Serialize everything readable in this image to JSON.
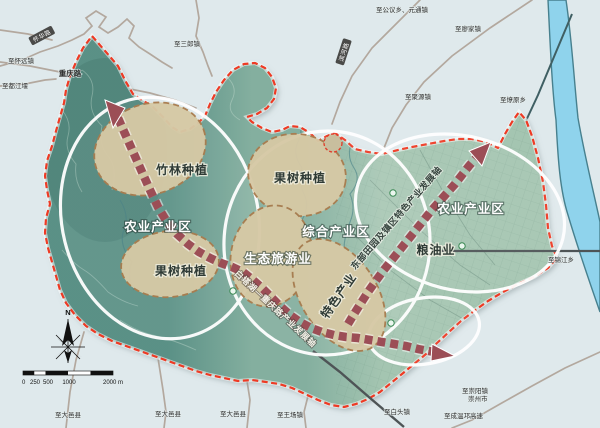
{
  "map": {
    "zones": [
      "农业产业区",
      "综合产业区",
      "农业产业区",
      "生态旅游业"
    ],
    "plots": [
      "竹林种植",
      "果树种植",
      "果树种植",
      "粮油业",
      "特色产业"
    ],
    "axes": [
      "白塔湖—重庆路产业发展轴",
      "东部田园及镇区特色产业发展轴"
    ],
    "roads": {
      "chongqing": "重庆路",
      "huaihua": "怀华路",
      "binhe": "滨河路"
    },
    "connections": [
      "至怀远镇",
      "至都江堰",
      "至三郎镇",
      "至公议乡、元通镇",
      "至廖家镇",
      "至聚源镇",
      "至燎原乡",
      "至锦江乡",
      "至崇阳镇",
      "崇州市",
      "至成温邛高速",
      "至白头镇",
      "至王场镇",
      "至大邑县",
      "至大邑县",
      "至大邑县"
    ],
    "compass": "N",
    "scalebar": {
      "ticks": [
        "0",
        "250",
        "500",
        "1000"
      ],
      "max": "2000 m"
    },
    "colors": {
      "boundary": "#ee3a24",
      "axis": "#9c4e56",
      "river": "#8fd3ec",
      "zone_outline": "#ffffff",
      "plot_fill": "#d6c9a5",
      "plot_border": "#a97c4e"
    }
  }
}
